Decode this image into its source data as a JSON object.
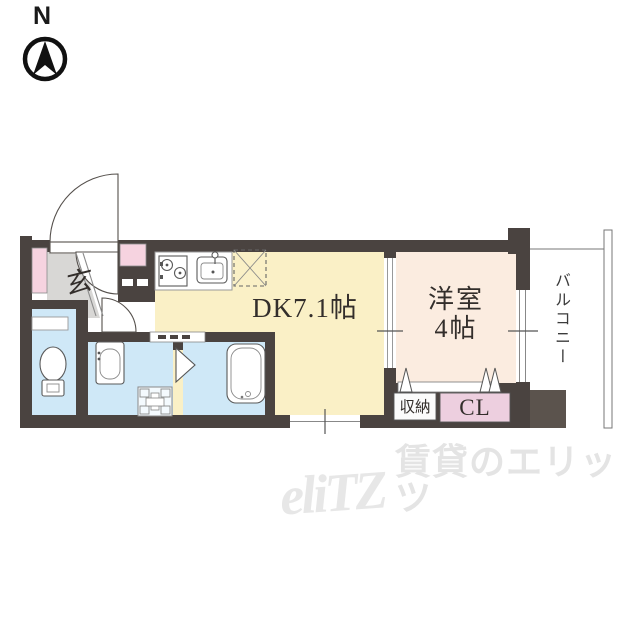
{
  "compass": {
    "north_label": "N"
  },
  "floor_plan": {
    "rooms": {
      "dk": {
        "label": "DK7.1帖"
      },
      "western_room": {
        "line1": "洋室",
        "line2": "4帖"
      },
      "entrance": {
        "label": "玄"
      },
      "storage": {
        "label": "収納"
      },
      "closet": {
        "label": "CL"
      },
      "balcony": {
        "label": "バルコニー"
      }
    },
    "colors": {
      "wall": "#4a4340",
      "wall_light": "#5b534d",
      "dk_floor": "#faf0c6",
      "western_floor": "#fbece0",
      "wet_area_floor": "#cfe8f7",
      "entrance_tile": "#d8d7d5",
      "cabinet_pink": "#f6d3e0",
      "closet_pink": "#edcfdf"
    }
  },
  "watermark": {
    "logo": "eliTZ",
    "text": "賃貸のエリッツ"
  }
}
